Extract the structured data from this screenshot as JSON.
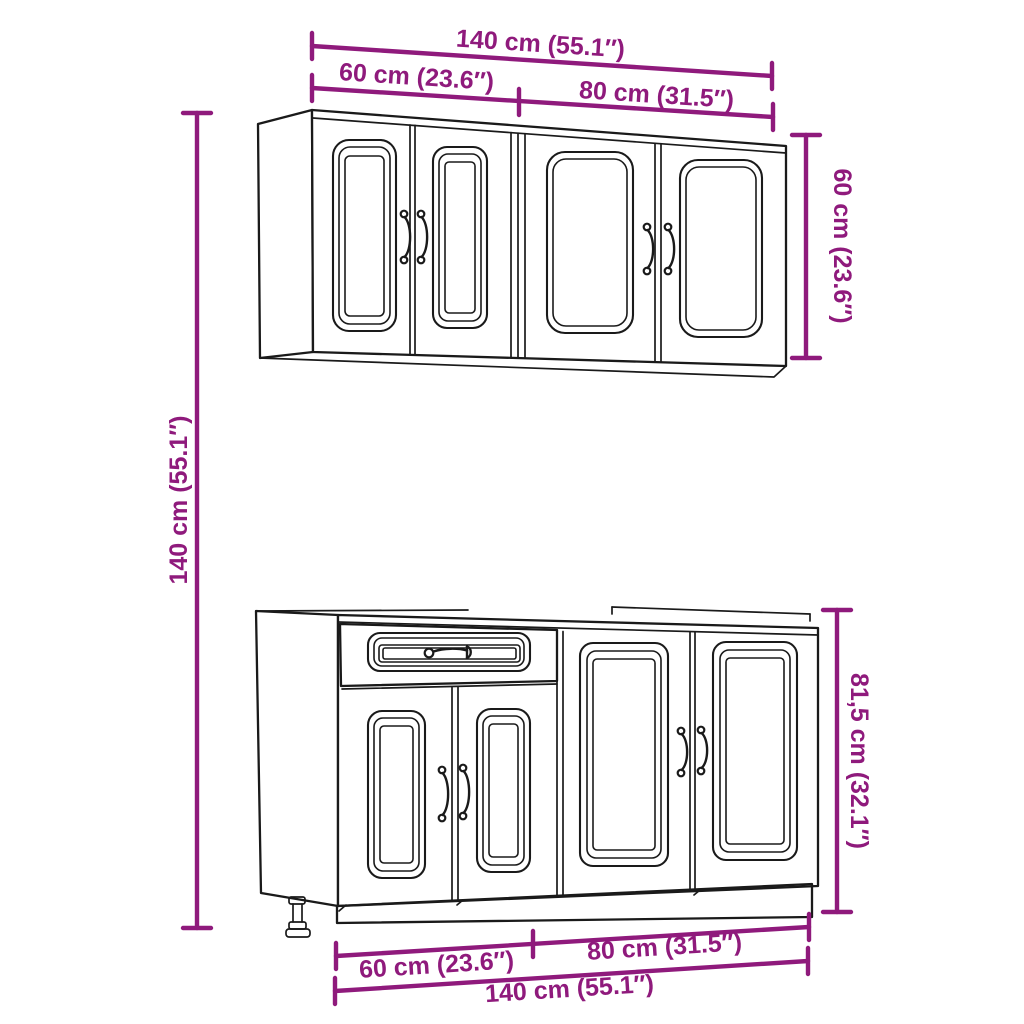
{
  "colors": {
    "dimension_accent": "#8F1A7C",
    "drawing_line": "#1A1A1A",
    "background": "#FFFFFF"
  },
  "drawing": {
    "subject": "kitchen cabinet set",
    "pieces": [
      "wall-cabinet",
      "base-cabinet"
    ],
    "wall_cabinet_doors": 4,
    "base_cabinet_doors": 4,
    "base_cabinet_drawers": 1
  },
  "labels": {
    "top_total_width": "140 cm (55.1″)",
    "top_left_width": "60 cm (23.6″)",
    "top_right_width": "80 cm (31.5″)",
    "wall_height": "60 cm (23.6″)",
    "overall_height": "140 cm (55.1″)",
    "base_height": "81,5 cm (32.1″)",
    "bottom_left_width": "60 cm (23.6″)",
    "bottom_right_width": "80 cm (31.5″)",
    "bottom_total_width": "140 cm (55.1″)"
  }
}
